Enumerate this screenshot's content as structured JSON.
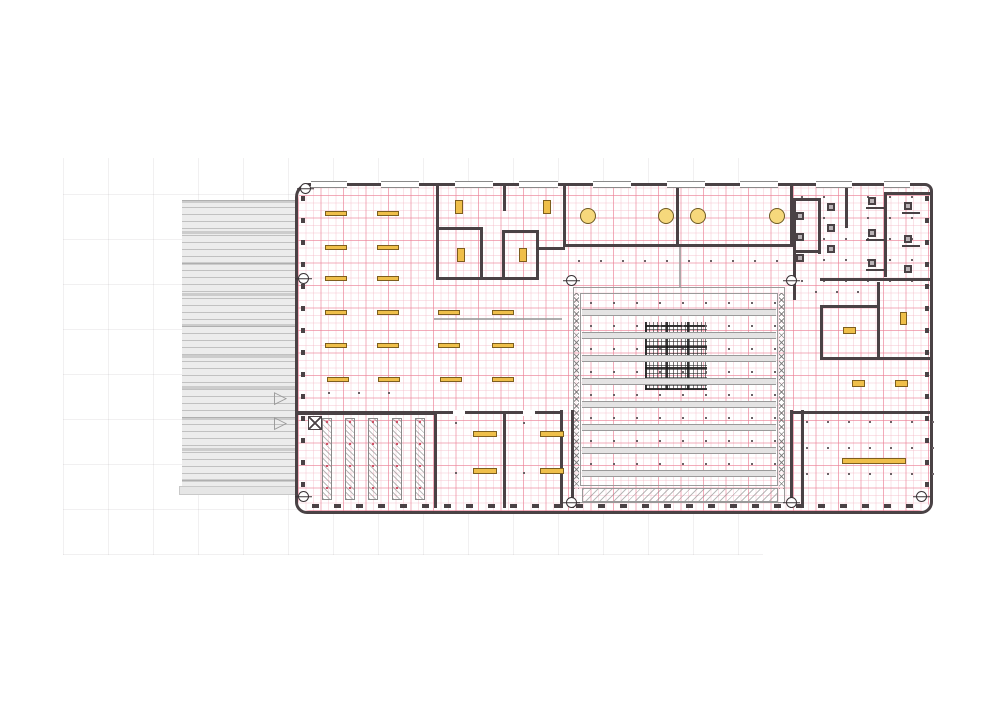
{
  "colors": {
    "wall": "#4a4245",
    "grid_major_pink": "#ec8096",
    "grid_minor_pink": "#f3b7c4",
    "furniture_fill": "#efbf4a",
    "furniture_border": "#7d5f1e",
    "table_circle_fill": "#f6d87c",
    "louver_gray": "#ececec",
    "frame_gray": "#9a9a9a",
    "background_grid": "#eeecee"
  },
  "plan": {
    "building": {
      "x": 295,
      "y": 183,
      "w": 638,
      "h": 331
    },
    "louver": {
      "x": 182,
      "y": 200,
      "w": 116,
      "h": 288
    },
    "louver_base": {
      "x": 179,
      "y": 486,
      "w": 122,
      "h": 9
    },
    "bg_grid": {
      "x": 63,
      "y": 158,
      "w": 700,
      "h": 397,
      "cell": 45
    },
    "walls": [
      [
        436,
        185,
        3,
        95
      ],
      [
        436,
        227,
        47,
        3
      ],
      [
        480,
        227,
        3,
        53
      ],
      [
        503,
        183,
        3,
        28
      ],
      [
        502,
        230,
        37,
        3
      ],
      [
        502,
        232,
        3,
        48
      ],
      [
        536,
        232,
        3,
        46
      ],
      [
        436,
        277,
        103,
        3
      ],
      [
        536,
        247,
        29,
        3
      ],
      [
        563,
        183,
        3,
        64
      ],
      [
        676,
        183,
        3,
        64
      ],
      [
        790,
        183,
        3,
        64
      ],
      [
        563,
        244,
        230,
        3
      ],
      [
        793,
        198,
        3,
        102
      ],
      [
        793,
        198,
        28,
        3
      ],
      [
        818,
        198,
        3,
        56
      ],
      [
        845,
        183,
        3,
        45
      ],
      [
        793,
        250,
        28,
        3
      ],
      [
        884,
        192,
        48,
        3
      ],
      [
        884,
        192,
        3,
        85
      ],
      [
        866,
        207,
        18,
        2
      ],
      [
        866,
        239,
        18,
        2
      ],
      [
        866,
        269,
        18,
        2
      ],
      [
        902,
        212,
        18,
        2
      ],
      [
        902,
        245,
        18,
        2
      ],
      [
        820,
        278,
        113,
        3
      ],
      [
        820,
        305,
        58,
        3
      ],
      [
        820,
        305,
        3,
        55
      ],
      [
        877,
        282,
        3,
        78
      ],
      [
        820,
        357,
        113,
        3
      ],
      [
        560,
        410,
        3,
        98
      ],
      [
        571,
        410,
        3,
        98
      ],
      [
        790,
        410,
        3,
        98
      ],
      [
        801,
        410,
        3,
        98
      ],
      [
        297,
        411,
        140,
        4
      ],
      [
        437,
        411,
        126,
        3
      ],
      [
        434,
        411,
        3,
        97
      ],
      [
        503,
        413,
        3,
        95
      ],
      [
        793,
        411,
        140,
        3
      ]
    ],
    "door_gaps": [
      [
        453,
        410,
        12,
        6
      ],
      [
        523,
        410,
        12,
        6
      ]
    ],
    "light_walls": [
      [
        679,
        246,
        2,
        41
      ],
      [
        434,
        318,
        128,
        2
      ]
    ],
    "desks": [
      [
        325,
        211,
        22,
        5
      ],
      [
        377,
        211,
        22,
        5
      ],
      [
        325,
        245,
        22,
        5
      ],
      [
        377,
        245,
        22,
        5
      ],
      [
        325,
        276,
        22,
        5
      ],
      [
        377,
        276,
        22,
        5
      ],
      [
        325,
        310,
        22,
        5
      ],
      [
        377,
        310,
        22,
        5
      ],
      [
        438,
        310,
        22,
        5
      ],
      [
        492,
        310,
        22,
        5
      ],
      [
        325,
        343,
        22,
        5
      ],
      [
        377,
        343,
        22,
        5
      ],
      [
        438,
        343,
        22,
        5
      ],
      [
        492,
        343,
        22,
        5
      ],
      [
        327,
        377,
        22,
        5
      ],
      [
        378,
        377,
        22,
        5
      ],
      [
        440,
        377,
        22,
        5
      ],
      [
        492,
        377,
        22,
        5
      ],
      [
        455,
        200,
        8,
        14
      ],
      [
        543,
        200,
        8,
        14
      ],
      [
        457,
        248,
        8,
        14
      ],
      [
        519,
        248,
        8,
        14
      ],
      [
        473,
        431,
        24,
        6
      ],
      [
        540,
        431,
        24,
        6
      ],
      [
        473,
        468,
        24,
        6
      ],
      [
        540,
        468,
        24,
        6
      ],
      [
        843,
        327,
        13,
        7
      ],
      [
        900,
        312,
        7,
        13
      ],
      [
        852,
        380,
        13,
        7
      ],
      [
        895,
        380,
        13,
        7
      ],
      [
        842,
        458,
        64,
        6
      ]
    ],
    "circles": [
      [
        588,
        216
      ],
      [
        666,
        216
      ],
      [
        698,
        216
      ],
      [
        777,
        216
      ]
    ],
    "circle_radius": 8,
    "fixtures": [
      [
        796,
        212
      ],
      [
        796,
        233
      ],
      [
        796,
        254
      ],
      [
        827,
        203
      ],
      [
        827,
        224
      ],
      [
        827,
        245
      ],
      [
        868,
        197
      ],
      [
        868,
        229
      ],
      [
        868,
        259
      ],
      [
        904,
        202
      ],
      [
        904,
        235
      ],
      [
        904,
        265
      ]
    ],
    "columns": [
      [
        305,
        188
      ],
      [
        303,
        278
      ],
      [
        303,
        496
      ],
      [
        921,
        496
      ],
      [
        571,
        280
      ],
      [
        791,
        280
      ],
      [
        571,
        502
      ],
      [
        791,
        502
      ]
    ],
    "dots_specs": [
      {
        "x": 578,
        "y": 260,
        "dx": 22,
        "dy": 0,
        "nx": 10,
        "ny": 1
      },
      {
        "x": 590,
        "y": 302,
        "dx": 23,
        "dy": 23,
        "nx": 9,
        "ny": 8
      },
      {
        "x": 328,
        "y": 392,
        "dx": 30,
        "dy": 0,
        "nx": 3,
        "ny": 1
      },
      {
        "x": 455,
        "y": 422,
        "dx": 68,
        "dy": 50,
        "nx": 2,
        "ny": 2
      },
      {
        "x": 801,
        "y": 196,
        "dx": 22,
        "dy": 21,
        "nx": 6,
        "ny": 5
      },
      {
        "x": 806,
        "y": 421,
        "dx": 21,
        "dy": 26,
        "nx": 7,
        "ny": 3
      },
      {
        "x": 815,
        "y": 291,
        "dx": 21,
        "dy": 0,
        "nx": 3,
        "ny": 1
      }
    ],
    "courtyard": {
      "outer": {
        "x": 573,
        "y": 287,
        "w": 212,
        "h": 216
      },
      "inner": {
        "x": 580,
        "y": 293,
        "w": 198,
        "h": 193
      },
      "zig_left": {
        "x": 574,
        "y": 293,
        "w": 5,
        "h": 196
      },
      "zig_right": {
        "x": 779,
        "y": 293,
        "w": 5,
        "h": 196
      },
      "bands_x": 582,
      "bands_w": 194,
      "bands_y": [
        309,
        332,
        355,
        378,
        401,
        424,
        447,
        470
      ],
      "mesh": {
        "x": 645,
        "y": 322,
        "w": 62,
        "h": 68
      },
      "hatch": {
        "x": 582,
        "y": 488,
        "w": 196,
        "h": 14
      }
    },
    "hatch_strips": [
      [
        322,
        418,
        10,
        82
      ],
      [
        345,
        418,
        10,
        82
      ],
      [
        368,
        418,
        10,
        82
      ],
      [
        392,
        418,
        10,
        82
      ],
      [
        415,
        418,
        10,
        82
      ]
    ],
    "windows_top": [
      [
        311,
        36
      ],
      [
        381,
        38
      ],
      [
        455,
        38
      ],
      [
        519,
        39
      ],
      [
        593,
        38
      ],
      [
        667,
        38
      ],
      [
        740,
        38
      ],
      [
        816,
        36
      ],
      [
        884,
        26
      ]
    ],
    "windows_y": 181,
    "xbox": {
      "x": 308,
      "y": 416
    },
    "door_marker_glyph": "▷",
    "door_markers": [
      [
        274,
        389
      ],
      [
        274,
        414
      ]
    ]
  }
}
